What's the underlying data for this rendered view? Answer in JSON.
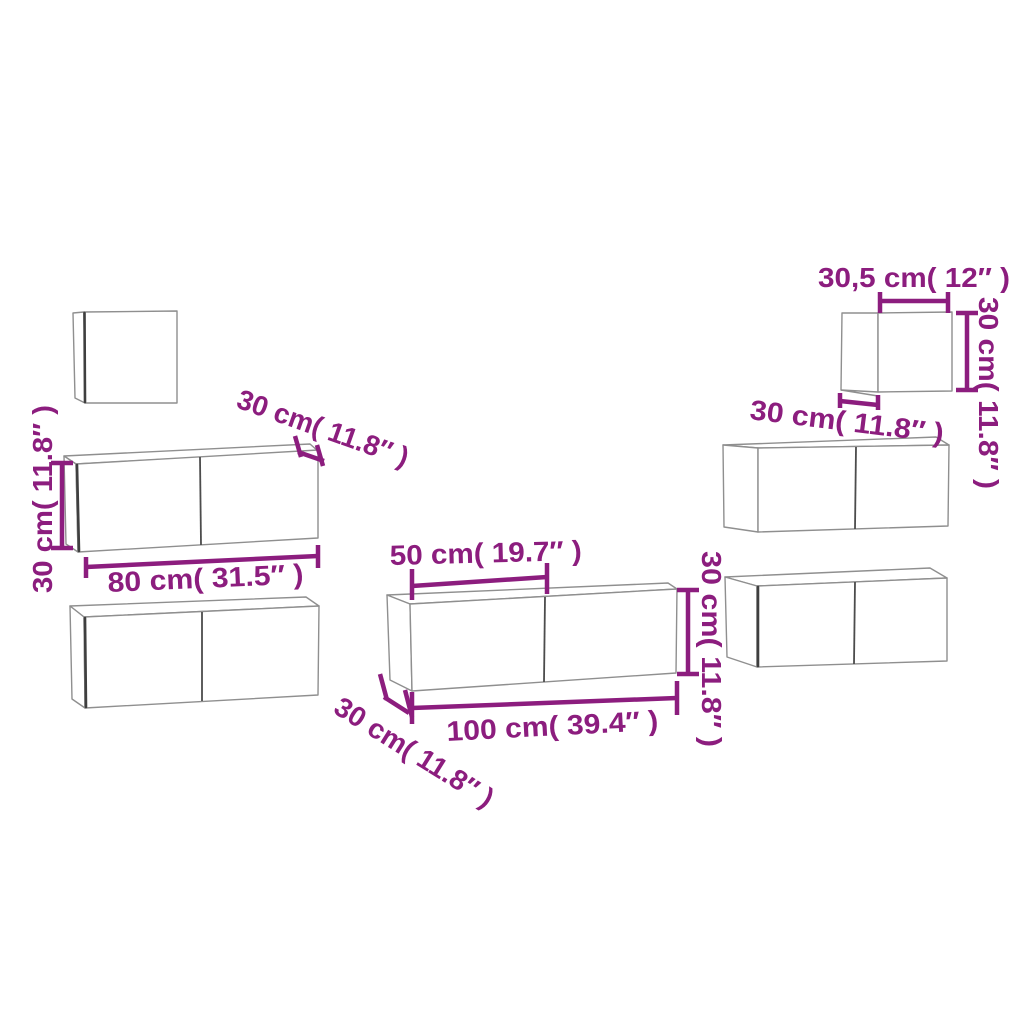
{
  "figure": {
    "type": "furniture-dimension-diagram",
    "piece_count": 7
  },
  "colors": {
    "background": "#ffffff",
    "dimension": "#8C1D7E",
    "outline": "#8F8F8F",
    "edge_dark": "#3F3F3F",
    "divider": "#4C4C4C"
  },
  "annotations": {
    "height_left": "30 cm( 11.8″ )",
    "depth_upper_80": "30 cm( 11.8″ )",
    "width_80": "80 cm( 31.5″ )",
    "depth_center": "30 cm( 11.8″ )",
    "door_50": "50 cm( 19.7″ )",
    "width_100": "100 cm( 39.4″ )",
    "height_center": "30 cm( 11.8″ )",
    "depth_top_right": "30 cm( 11.8″ )",
    "width_305": "30,5 cm( 12″ )",
    "height_top_right": "30 cm( 11.8″ )"
  }
}
